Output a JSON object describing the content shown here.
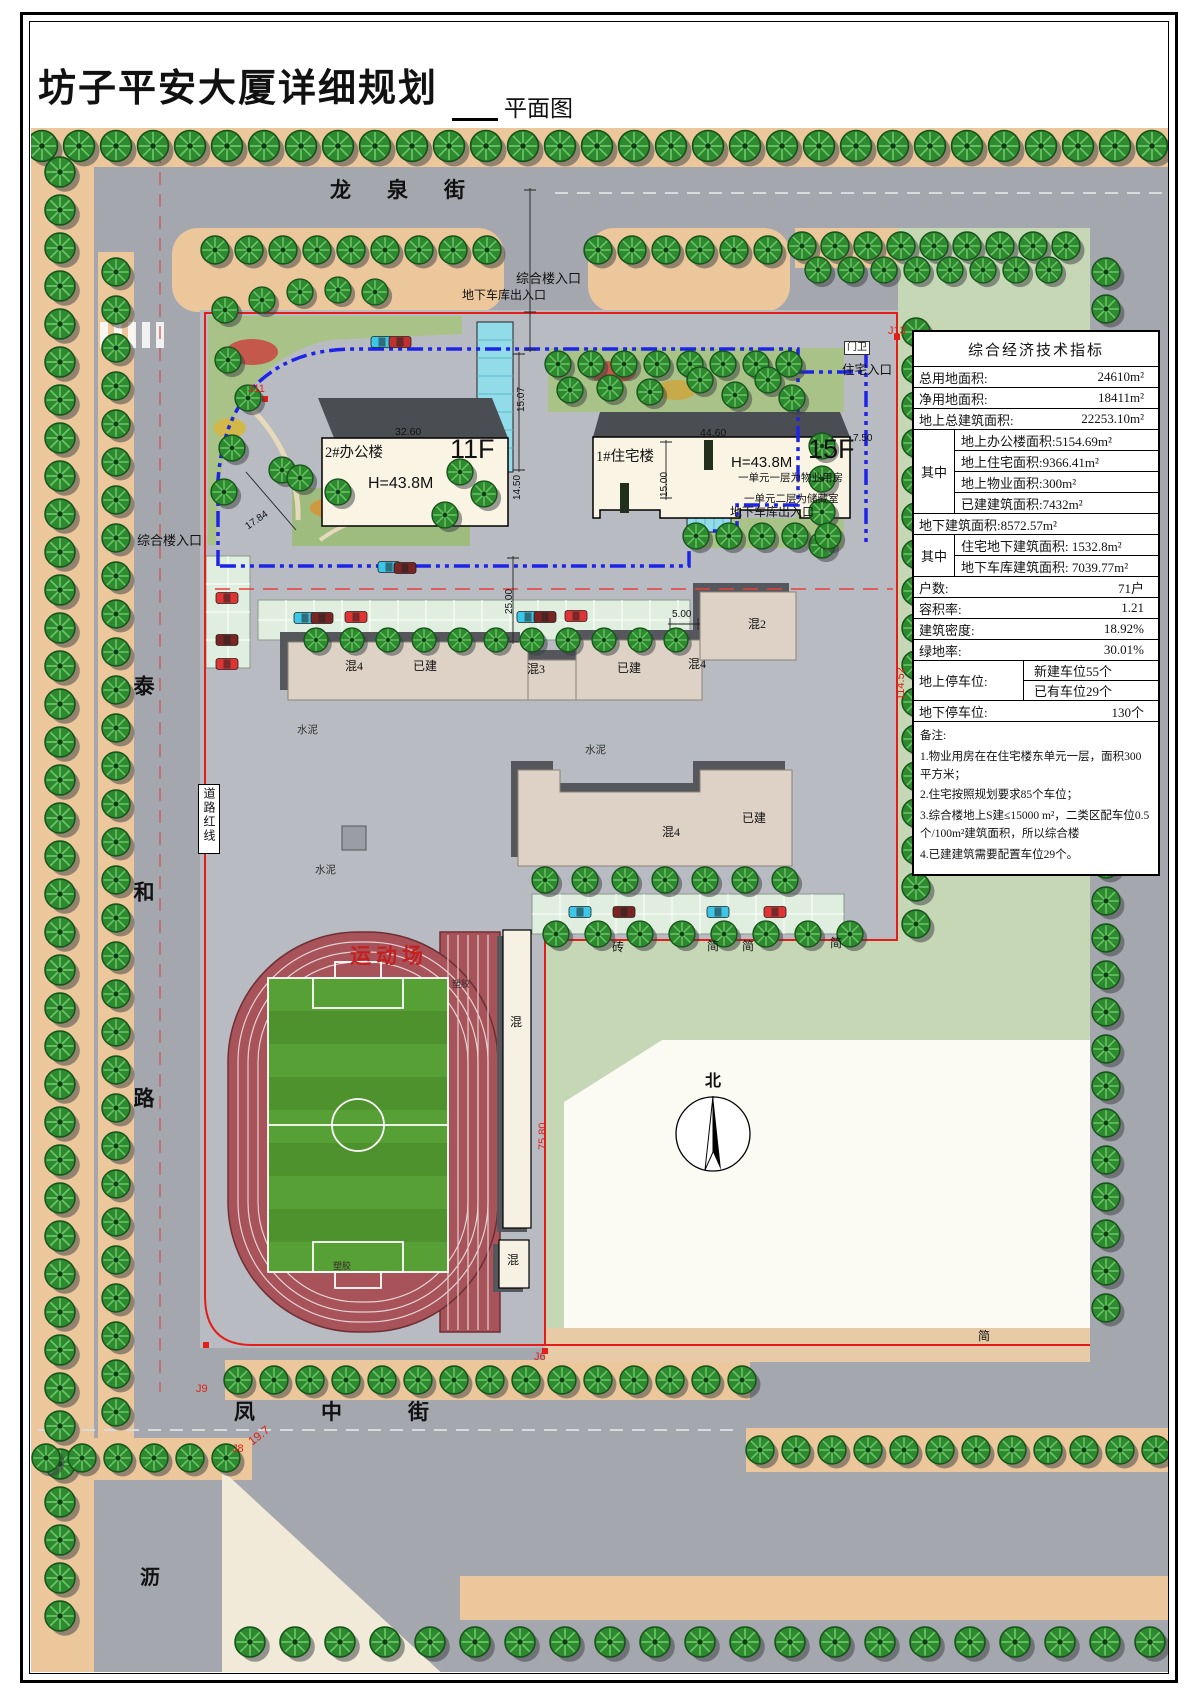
{
  "page": {
    "title": "坊子平安大厦详细规划",
    "subtitle": "平面图"
  },
  "streets": {
    "north": "龙泉街",
    "west": "泰和路",
    "south": "凤中街",
    "corner": "沥"
  },
  "compass": {
    "north_label": "北"
  },
  "stadium": {
    "name": "运动场",
    "surface_label": "塑胶"
  },
  "buildings": {
    "office": {
      "name": "2#办公楼",
      "floors": "11F",
      "height": "H=43.8M"
    },
    "residential": {
      "name": "1#住宅楼",
      "floors": "15F",
      "height": "H=43.8M",
      "unit_note_1": "一单元一层为物业用房",
      "unit_note_2": "一单元二层为储藏室"
    },
    "existing": {
      "hun4": "混4",
      "hun3": "混3",
      "hun2": "混2",
      "hun": "混",
      "built": "已建"
    }
  },
  "site_labels": {
    "entrance_complex": "综合楼入口",
    "entrance_garage": "地下车库出入口",
    "entrance_residential": "住宅入口",
    "gatehouse": "门卫",
    "road_red_line": "道路红线",
    "cement": "水泥",
    "brick": "砖",
    "simple": "简"
  },
  "dimensions": {
    "office_width": "32.60",
    "residential_width": "44.60",
    "d15_07": "15.07",
    "d14_50": "14.50",
    "d15_00": "15.00",
    "d25_00": "25.00",
    "d5_00": "5.00",
    "d7_50": "7.50",
    "d17_84": "17.84",
    "d114_52": "114.52",
    "d75_80": "75.80",
    "corner_radius": "19.7"
  },
  "survey_points": {
    "j11": "J11",
    "j13": "J13",
    "j9": "J9",
    "j8": "J8",
    "j6": "J6"
  },
  "indicators": {
    "title": "综合经济技术指标",
    "rows": [
      {
        "label": "总用地面积:",
        "value": "24610m²"
      },
      {
        "label": "净用地面积:",
        "value": "18411m²"
      },
      {
        "label": "地上总建筑面积:",
        "value": "22253.10m²"
      }
    ],
    "group1_label": "其中",
    "group1_items": [
      "地上办公楼面积:5154.69m²",
      "地上住宅面积:9366.41m²",
      "地上物业面积:300m²",
      "已建建筑面积:7432m²"
    ],
    "underground_total": "地下建筑面积:8572.57m²",
    "group2_label": "其中",
    "group2_items": [
      "住宅地下建筑面积: 1532.8m²",
      "地下车库建筑面积: 7039.77m²"
    ],
    "rows2": [
      {
        "label": "户数:",
        "value": "71户"
      },
      {
        "label": "容积率:",
        "value": "1.21"
      },
      {
        "label": "建筑密度:",
        "value": "18.92%"
      },
      {
        "label": "绿地率:",
        "value": "30.01%"
      }
    ],
    "parking_surface_label": "地上停车位:",
    "parking_surface_new": "新建车位55个",
    "parking_surface_existing": "已有车位29个",
    "parking_underground_label": "地下停车位:",
    "parking_underground_value": "130个",
    "notes_title": "备注:",
    "notes": [
      "1.物业用房在在住宅楼东单元一层，面积300平方米；",
      "2.住宅按照规划要求85个车位；",
      "3.综合楼地上S建≤15000 m²，二类区配车位0.5个/100m²建筑面积，所以综合楼",
      "4.已建建筑需要配置车位29个。"
    ]
  },
  "colors": {
    "boundary_red": "#e31e18",
    "control_line_blue": "#1d24e8",
    "track_red": "#a8525a",
    "field_green": "#57a035",
    "ramp_cyan": "#92dcea",
    "tree_green": "#2e8a2e",
    "road_gray": "#a4a7ad",
    "sidewalk_tan": "#ecc79c",
    "lawn_green": "#a9c287",
    "panel_green": "#c6d7b5"
  }
}
